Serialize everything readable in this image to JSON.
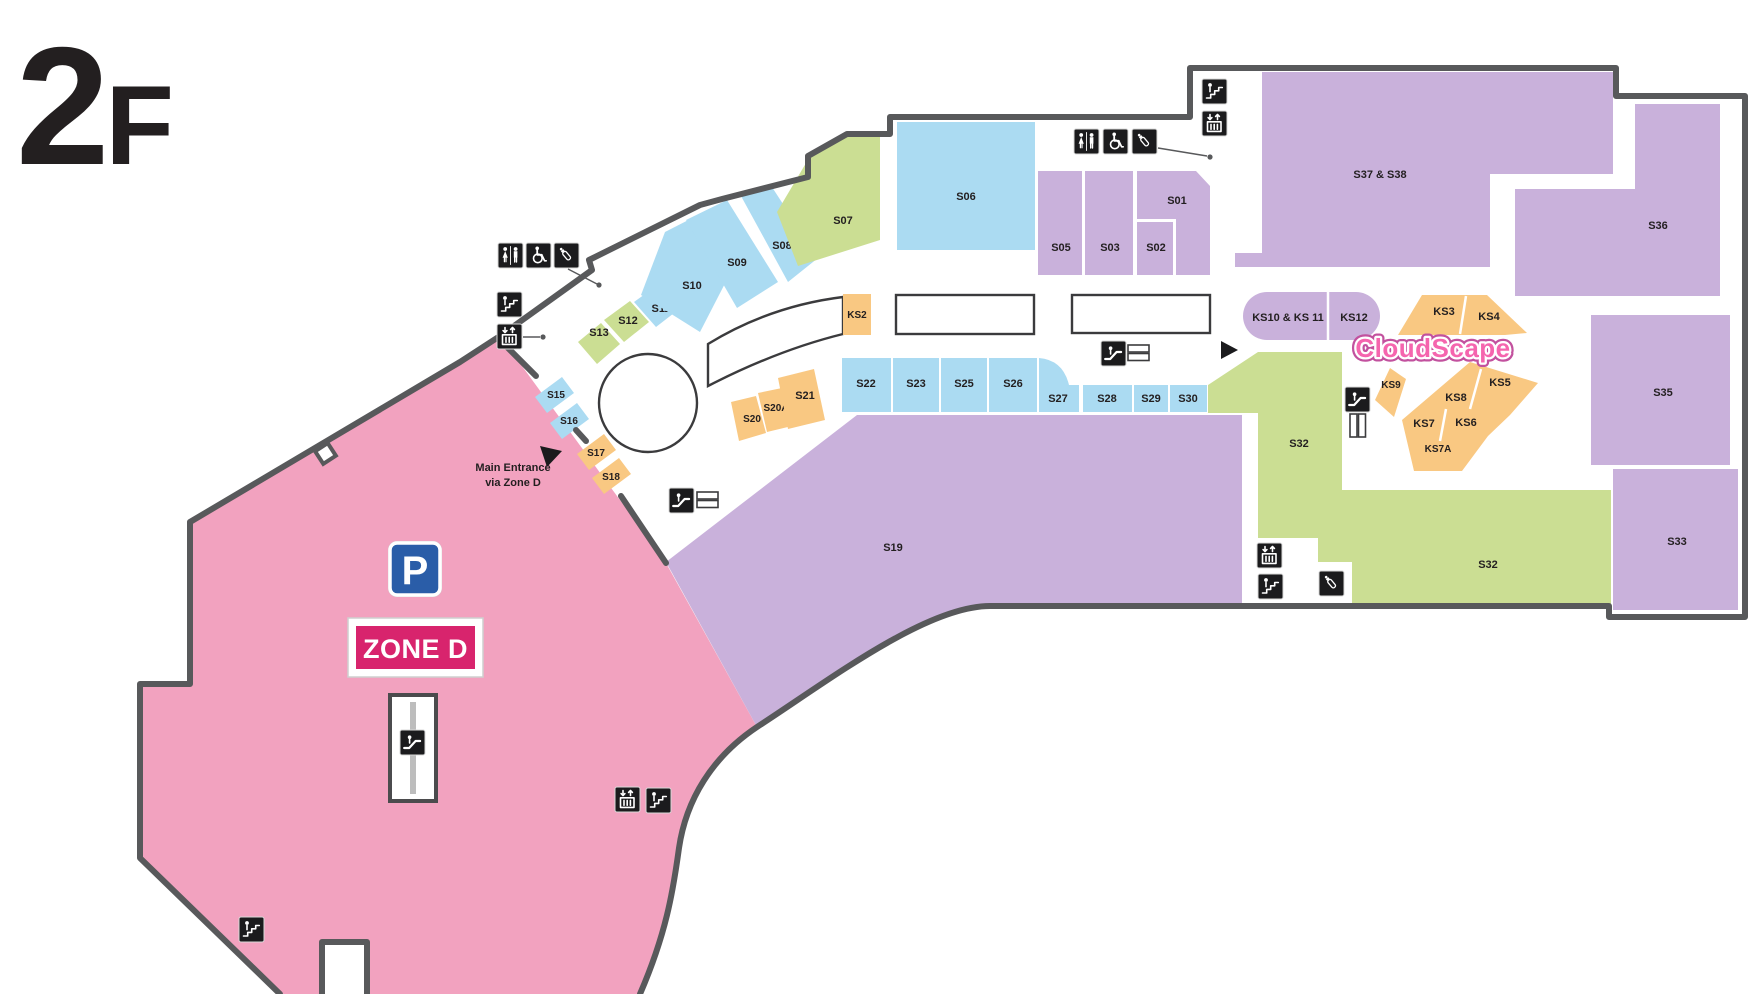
{
  "floor": {
    "number": "2",
    "suffix": "F"
  },
  "zone_d": {
    "badge": "ZONE D",
    "parking": "P"
  },
  "entrance": {
    "line1": "Main Entrance",
    "line2": "via Zone D"
  },
  "brand": {
    "cloudscape": "CloudScape"
  },
  "shops": {
    "s01": "S01",
    "s02": "S02",
    "s03": "S03",
    "s05": "S05",
    "s06": "S06",
    "s07": "S07",
    "s08": "S08",
    "s09": "S09",
    "s10": "S10",
    "s11": "S11",
    "s12": "S12",
    "s13": "S13",
    "s15": "S15",
    "s16": "S16",
    "s17": "S17",
    "s18": "S18",
    "s19": "S19",
    "s20": "S20",
    "s20a": "S20A",
    "s21": "S21",
    "s22": "S22",
    "s23": "S23",
    "s25": "S25",
    "s26": "S26",
    "s27": "S27",
    "s28": "S28",
    "s29": "S29",
    "s30": "S30",
    "s32a": "S32",
    "s32b": "S32",
    "s33": "S33",
    "s35": "S35",
    "s36": "S36",
    "s37_38": "S37 & S38",
    "ks2": "KS2",
    "ks3": "KS3",
    "ks4": "KS4",
    "ks5": "KS5",
    "ks6": "KS6",
    "ks7": "KS7",
    "ks7a": "KS7A",
    "ks8": "KS8",
    "ks9": "KS9",
    "ks10_11": "KS10 & KS 11",
    "ks12": "KS12"
  },
  "colors": {
    "wall": "#58595B",
    "retail_blue": "#ABDBF2",
    "retail_purple": "#C9B1DB",
    "retail_green": "#CBDE93",
    "kiosk_orange": "#F9C882",
    "zone_pink": "#F2A2BF",
    "badge_magenta": "#D8246D",
    "parking_blue": "#2A5DA8",
    "cloudscape_pink": "#F565AE"
  },
  "icons": {
    "restroom": "restroom-icon",
    "accessible": "accessible-icon",
    "nursery": "baby-care-icon",
    "stairs": "stairs-icon",
    "elevator": "elevator-icon",
    "escalator": "escalator-icon",
    "parking": "parking-icon",
    "entrance_marker": "entrance-arrow-icon"
  }
}
